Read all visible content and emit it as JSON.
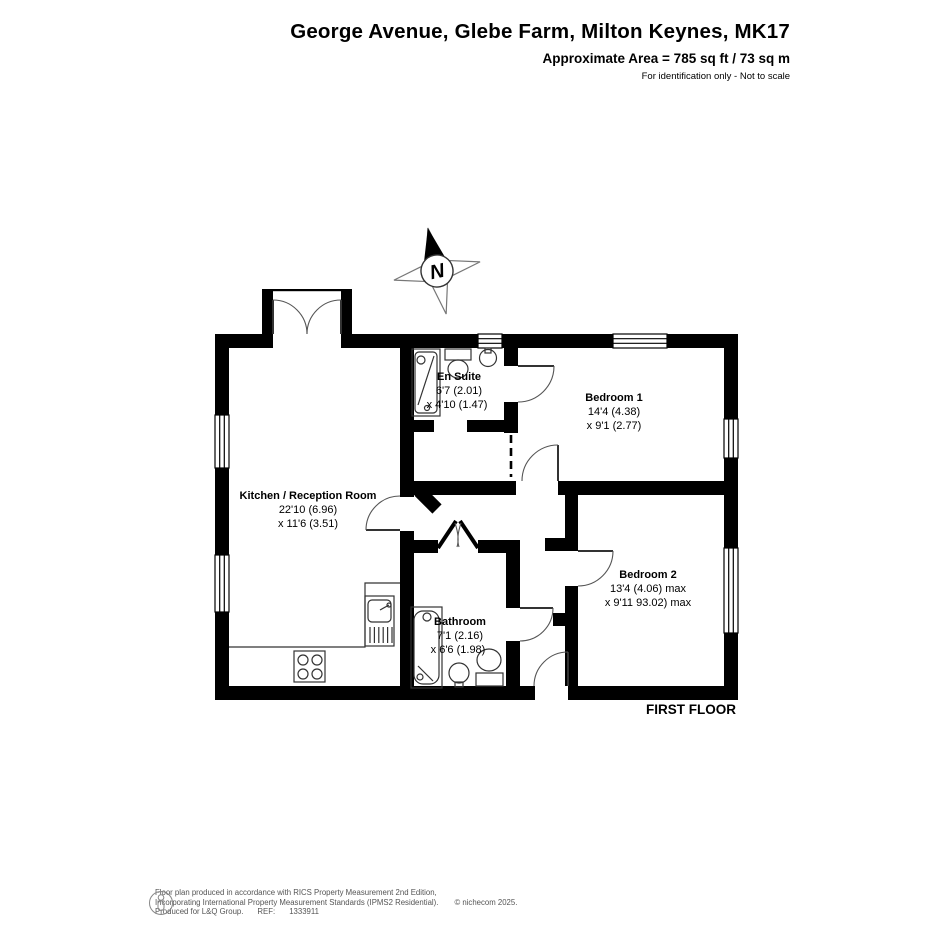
{
  "header": {
    "title": "George Avenue, Glebe Farm, Milton Keynes, MK17",
    "area_line": "Approximate Area = 785 sq ft / 73 sq m",
    "disclaimer": "For identification only - Not to scale"
  },
  "compass": {
    "label": "N"
  },
  "floor_label": "FIRST FLOOR",
  "rooms": {
    "kitchen": {
      "name": "Kitchen / Reception Room",
      "dim1": "22'10 (6.96)",
      "dim2": "x 11'6 (3.51)"
    },
    "ensuite": {
      "name": "En Suite",
      "dim1": "6'7 (2.01)",
      "dim2": "x 4'10 (1.47)"
    },
    "bedroom1": {
      "name": "Bedroom 1",
      "dim1": "14'4 (4.38)",
      "dim2": "x 9'1 (2.77)"
    },
    "bedroom2": {
      "name": "Bedroom 2",
      "dim1": "13'4 (4.06) max",
      "dim2": "x 9'11 93.02) max"
    },
    "bathroom": {
      "name": "Bathroom",
      "dim1": "7'1 (2.16)",
      "dim2": "x 6'6 (1.98)"
    }
  },
  "footer": {
    "line1": "Floor plan produced in accordance with RICS Property Measurement 2nd Edition,",
    "line2": "Incorporating International Property Measurement Standards (IPMS2 Residential).",
    "copyright": "© nichecom 2025.",
    "line3_prefix": "Produced for L&Q Group.",
    "ref_label": "REF:",
    "ref_value": "1333911"
  },
  "colors": {
    "wall": "#000000",
    "door_line": "#555555",
    "footer_text": "#555555"
  }
}
